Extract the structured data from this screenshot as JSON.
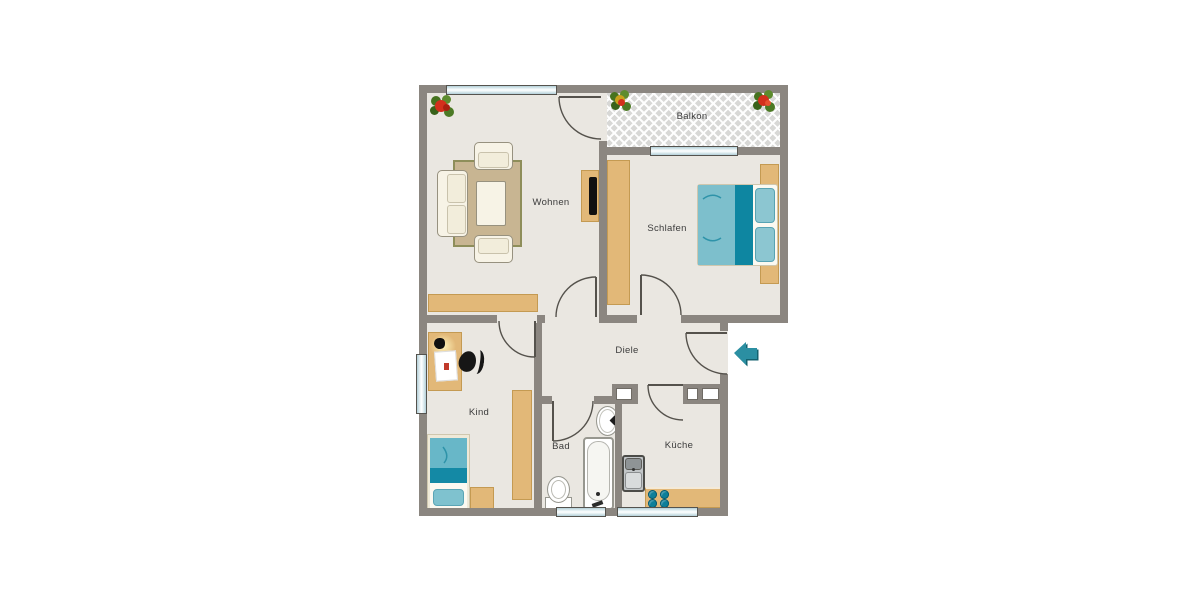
{
  "meta": {
    "type": "apartment-floor-plan"
  },
  "rooms": {
    "wohnen": {
      "label": "Wohnen"
    },
    "schlafen": {
      "label": "Schlafen"
    },
    "balkon": {
      "label": "Balkon"
    },
    "diele": {
      "label": "Diele"
    },
    "kind": {
      "label": "Kind"
    },
    "bad": {
      "label": "Bad"
    },
    "kueche": {
      "label": "Küche"
    }
  },
  "entrance": {
    "icon": "arrow-left",
    "color": "#2b8fa2"
  },
  "icons": {
    "plant": "potted-plant",
    "entrance_arrow": "left-arrow"
  },
  "colors": {
    "wall": "#8b8680",
    "floor": "#eae7e1",
    "furniture_wood": "#e2b878",
    "rug": "#c8b592",
    "accent_teal": "#1489a5",
    "accent_teal_light": "#7dbfcc",
    "window_glass": "#cfe3e8",
    "entrance_arrow": "#2b8fa2"
  }
}
